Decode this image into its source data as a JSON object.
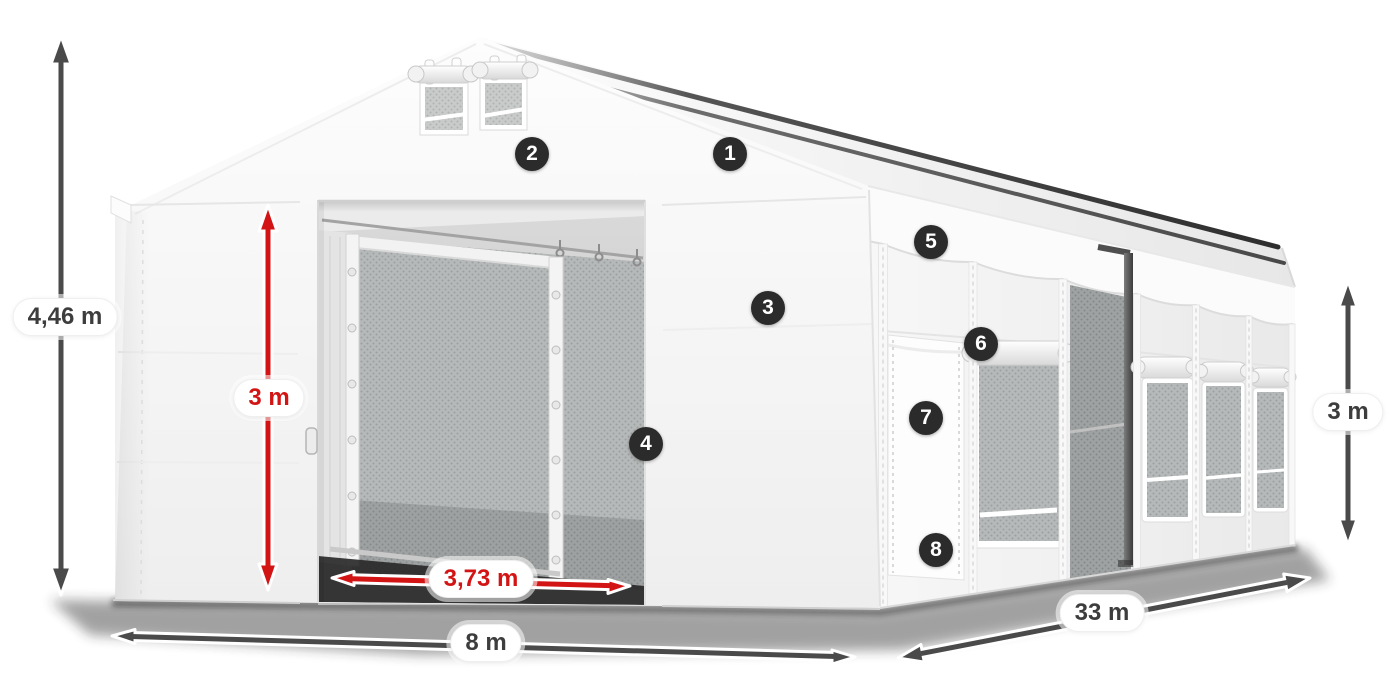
{
  "scene": {
    "background": "#ffffff"
  },
  "colors": {
    "dimension_dark": "#4a4a4a",
    "dimension_red": "#d31414",
    "badge": "#2b2b2b",
    "badge_text": "#ffffff",
    "pill_background": "#ffffff",
    "pill_text": "#3d3d3d"
  },
  "dimensions": {
    "total_height": {
      "label": "4,46 m",
      "color": "dark"
    },
    "door_height": {
      "label": "3 m",
      "color": "red"
    },
    "door_width": {
      "label": "3,73 m",
      "color": "red"
    },
    "width": {
      "label": "8 m",
      "color": "dark"
    },
    "length": {
      "label": "33 m",
      "color": "dark"
    },
    "side_height": {
      "label": "3 m",
      "color": "dark"
    }
  },
  "markers": [
    {
      "number": "1"
    },
    {
      "number": "2"
    },
    {
      "number": "3"
    },
    {
      "number": "4"
    },
    {
      "number": "5"
    },
    {
      "number": "6"
    },
    {
      "number": "7"
    },
    {
      "number": "8"
    }
  ]
}
